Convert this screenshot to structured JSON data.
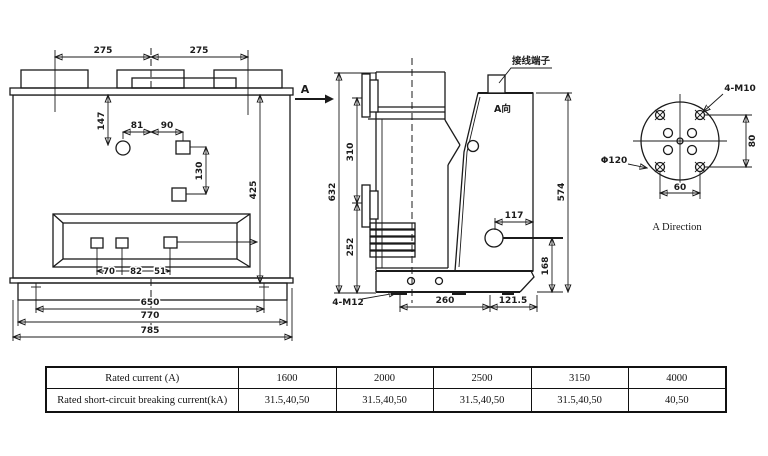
{
  "drawing": {
    "front": {
      "d275l": "275",
      "d275r": "275",
      "d147": "147",
      "d81": "81",
      "d90": "90",
      "d130": "130",
      "d425": "425",
      "d70": "70",
      "d82": "82",
      "d51": "51",
      "d650": "650",
      "d770": "770",
      "d785": "785"
    },
    "side": {
      "arrow_label": "A",
      "d632": "632",
      "d310": "310",
      "d252": "252",
      "terminal": "接线端子",
      "a_view": "A向",
      "d117": "117",
      "d168": "168",
      "d574": "574",
      "bolt": "4-M12",
      "d260": "260",
      "d121_5": "121.5"
    },
    "aview": {
      "bolt": "4-M10",
      "dia": "Φ120",
      "d80": "80",
      "d60": "60",
      "title": "A Direction"
    }
  },
  "table": {
    "rows": [
      {
        "label": "Rated current (A)",
        "values": [
          "1600",
          "2000",
          "2500",
          "3150",
          "4000"
        ]
      },
      {
        "label": "Rated short-circuit breaking current(kA)",
        "values": [
          "31.5,40,50",
          "31.5,40,50",
          "31.5,40,50",
          "31.5,40,50",
          "40,50"
        ]
      }
    ]
  },
  "colors": {
    "line": "#1b1b1b",
    "background": "#ffffff"
  }
}
